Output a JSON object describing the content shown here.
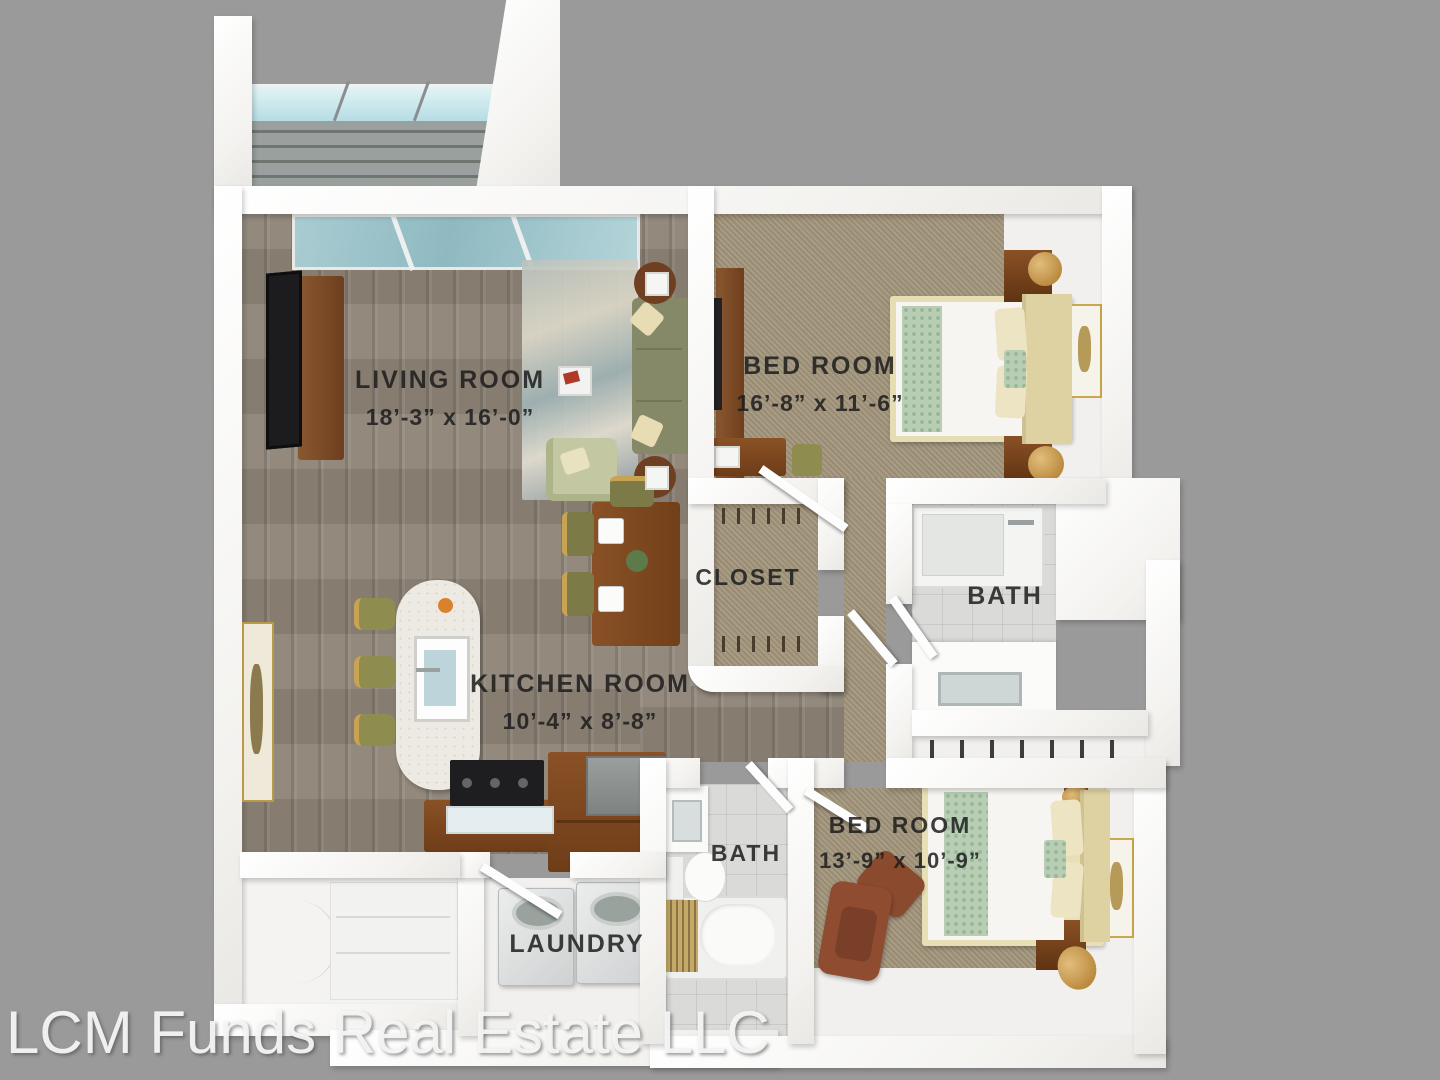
{
  "watermark": "LCM Funds Real Estate LLC",
  "rooms": {
    "living": {
      "name": "LIVING ROOM",
      "dims": "18’-3” x 16’-0”"
    },
    "bed1": {
      "name": "BED ROOM",
      "dims": "16’-8” x 11’-6”"
    },
    "closet": {
      "name": "CLOSET"
    },
    "bath1": {
      "name": "BATH"
    },
    "kitchen": {
      "name": "KITCHEN ROOM",
      "dims": "10’-4” x 8’-8”"
    },
    "bath2": {
      "name": "BATH"
    },
    "bed2": {
      "name": "BED ROOM",
      "dims": "13’-9” x 10’-9”"
    },
    "laundry": {
      "name": "LAUNDRY"
    }
  },
  "colors": {
    "background": "#9a9a9a",
    "wall": "#f7f6f3",
    "wood_floor": "#8d8376",
    "carpet": "#a3957b",
    "tile": "#dadad8",
    "label_text": "#1c1c1c",
    "watermark_text": "#f6f6f6",
    "sofa_olive": "#868968",
    "bed_runner_green": "#b7cdb4",
    "wood_furniture": "#7a4a28",
    "glass": "#b5dde4"
  }
}
